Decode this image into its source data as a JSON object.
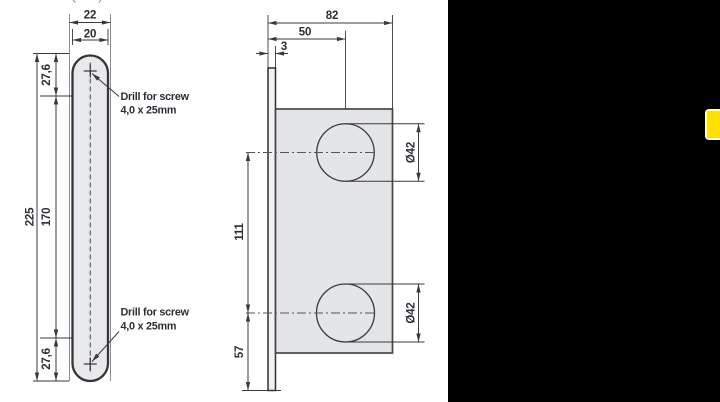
{
  "front_view": {
    "width_outer": "22",
    "width_inner": "20",
    "height_total": "225",
    "hole_spacing": "170",
    "offset_top": "27,6",
    "offset_bottom": "27,6",
    "drill_note_top": {
      "line1": "Drill for screw",
      "line2": "4,0 x 25mm"
    },
    "drill_note_bottom": {
      "line1": "Drill for screw",
      "line2": "4,0 x 25mm"
    }
  },
  "side_view": {
    "depth_total": "82",
    "hole_center_depth": "50",
    "plate_thickness": "3",
    "hole_spacing": "111",
    "offset_bottom": "57",
    "hole_diameter_top": "Ø42",
    "hole_diameter_bottom": "Ø42"
  },
  "side_panel": {
    "tab_color": "#ffe000",
    "panel_bg": "#000000"
  },
  "colors": {
    "line": "#3a3a3e",
    "plate_fill": "#e8e9ea",
    "body_fill": "#e4e5e7",
    "text": "#2d2d35"
  }
}
